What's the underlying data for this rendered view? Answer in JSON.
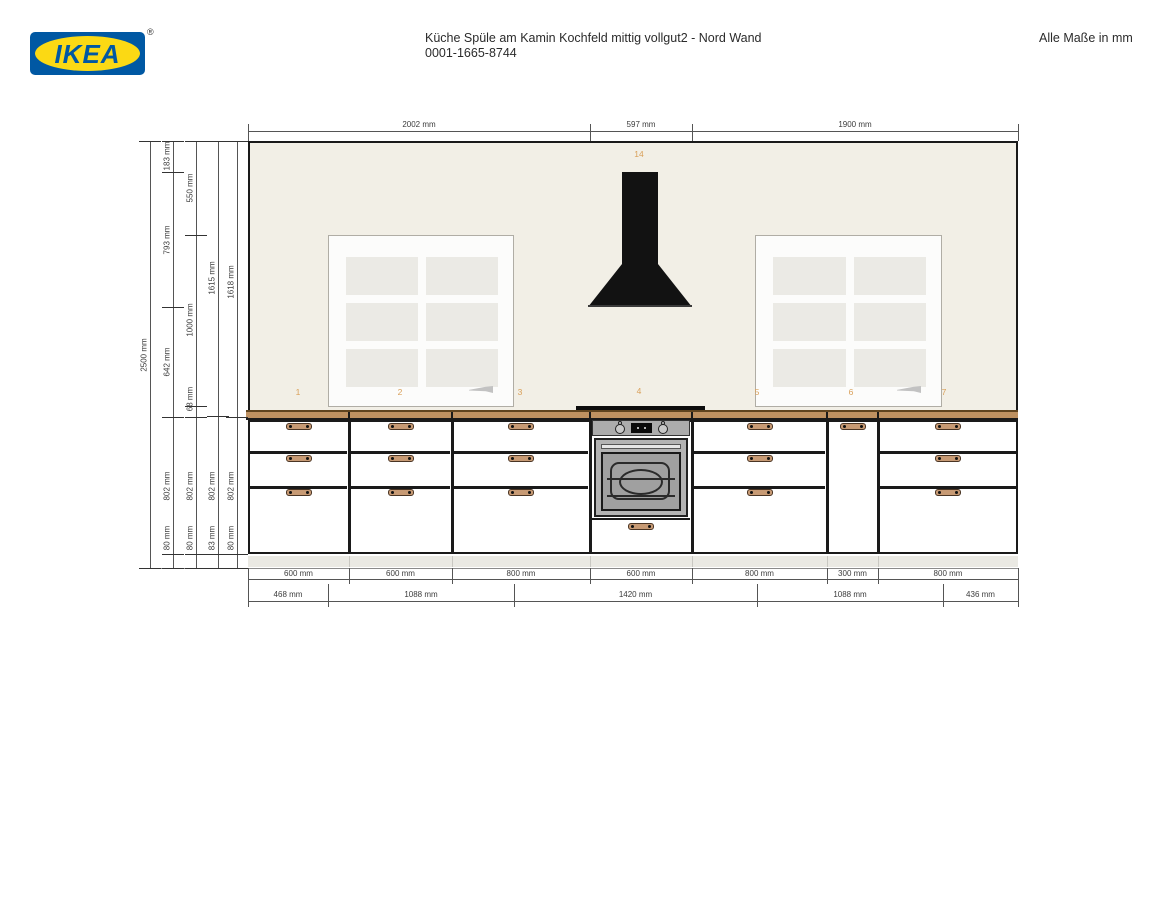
{
  "header": {
    "logo_text": "IKEA",
    "registered_mark": "®",
    "title_line1": "Küche Spüle am Kamin Kochfeld mittig vollgut2 - Nord Wand",
    "title_line2": "0001-1665-8744",
    "units_note": "Alle Maße in mm"
  },
  "colors": {
    "ikea_blue": "#0058A3",
    "ikea_yellow": "#FBD914",
    "wall": "#F2EFE6",
    "window_frame": "#FCFCFB",
    "window_pane": "#EBEAE5",
    "hood": "#121212",
    "countertop": "#BE9161",
    "countertop_edge": "#5E431F",
    "outline": "#1a1a1a",
    "handle": "#C79A74",
    "plinth": "#EAE9E3",
    "dimension_line": "#555555",
    "item_number": "#D9A05A",
    "oven_panel": "#ACACAC",
    "oven_glass": "#A0A0A0"
  },
  "dimensions": {
    "top": [
      "2002 mm",
      "597 mm",
      "1900 mm"
    ],
    "left_columns": [
      {
        "labels": [
          "2500 mm"
        ]
      },
      {
        "labels": [
          "183 mm",
          "793 mm",
          "642 mm",
          "802 mm",
          "80 mm"
        ]
      },
      {
        "labels": [
          "550 mm",
          "1000 mm",
          "68 mm",
          "802 mm",
          "80 mm"
        ]
      },
      {
        "labels": [
          "1615 mm",
          "802 mm",
          "83 mm"
        ]
      },
      {
        "labels": [
          "1618 mm",
          "802 mm",
          "80 mm"
        ]
      }
    ],
    "cabinet_widths": [
      "600 mm",
      "600 mm",
      "800 mm",
      "600 mm",
      "800 mm",
      "300 mm",
      "800 mm"
    ],
    "wall_spans": [
      "468 mm",
      "1088 mm",
      "1420 mm",
      "1088 mm",
      "436 mm"
    ]
  },
  "item_numbers": [
    "1",
    "2",
    "3",
    "4",
    "5",
    "6",
    "7",
    "14"
  ]
}
